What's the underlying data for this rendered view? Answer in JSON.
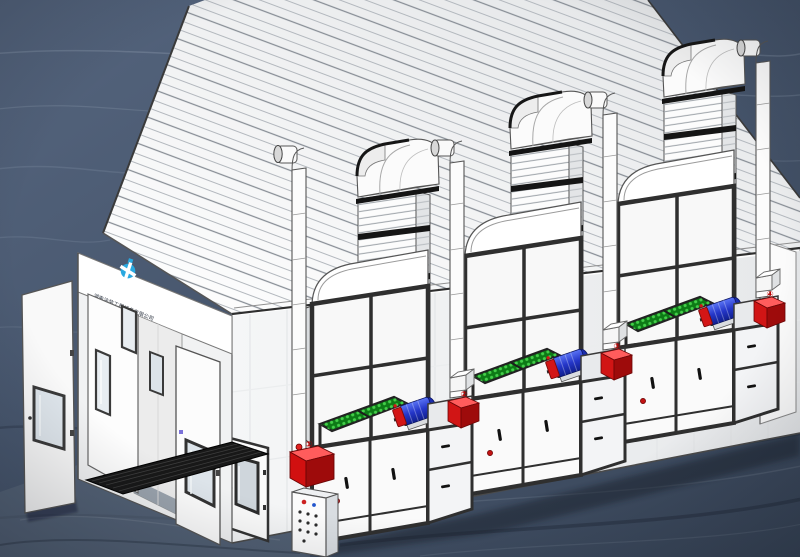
{
  "meta": {
    "canvas_width": 800,
    "canvas_height": 557,
    "scene": "3D technical illustration of an industrial spray paint booth with three exhaust fan units, ribbed chimneys, filter cabinets and open entrance doors on a dark slate background"
  },
  "branding": {
    "company_name": "湖南涂装工程设备有限公司",
    "logo": "blue pinwheel mark",
    "logo_color": "#29a8e0"
  },
  "annotations": {
    "markers": [
      {
        "label": "①",
        "component": "control junction box"
      },
      {
        "label": "②",
        "component": "unit 1 junction box"
      },
      {
        "label": "③",
        "component": "unit 2 junction box"
      },
      {
        "label": "④",
        "component": "unit 3 junction box"
      }
    ]
  },
  "palette": {
    "background_slate": "#46536a",
    "booth_white": "#fafafa",
    "frame_dark": "#2f2f2f",
    "filter_green_base": "#0d7a16",
    "filter_green_dot": "#44cf4a",
    "motor_blue": "#2436c8",
    "alert_red": "#d11515",
    "logo_blue": "#29a8e0",
    "grating_black": "#181818",
    "ground_shadow": "#1f2733"
  },
  "components": {
    "exhaust_unit_count": 3,
    "per_unit": [
      "ribbed exhaust chimney with elbow cap",
      "intake pipe with elbow",
      "upper filter cabinet with hood",
      "green filter grid",
      "belt-drive fan motor",
      "lower door cabinet with handles",
      "red junction box",
      "red valve"
    ],
    "front": [
      "open entrance door leaves with windows",
      "narrow observation windows",
      "personnel access door",
      "floor grating",
      "push-button control panel",
      "control junction box",
      "front intake pipe"
    ]
  }
}
